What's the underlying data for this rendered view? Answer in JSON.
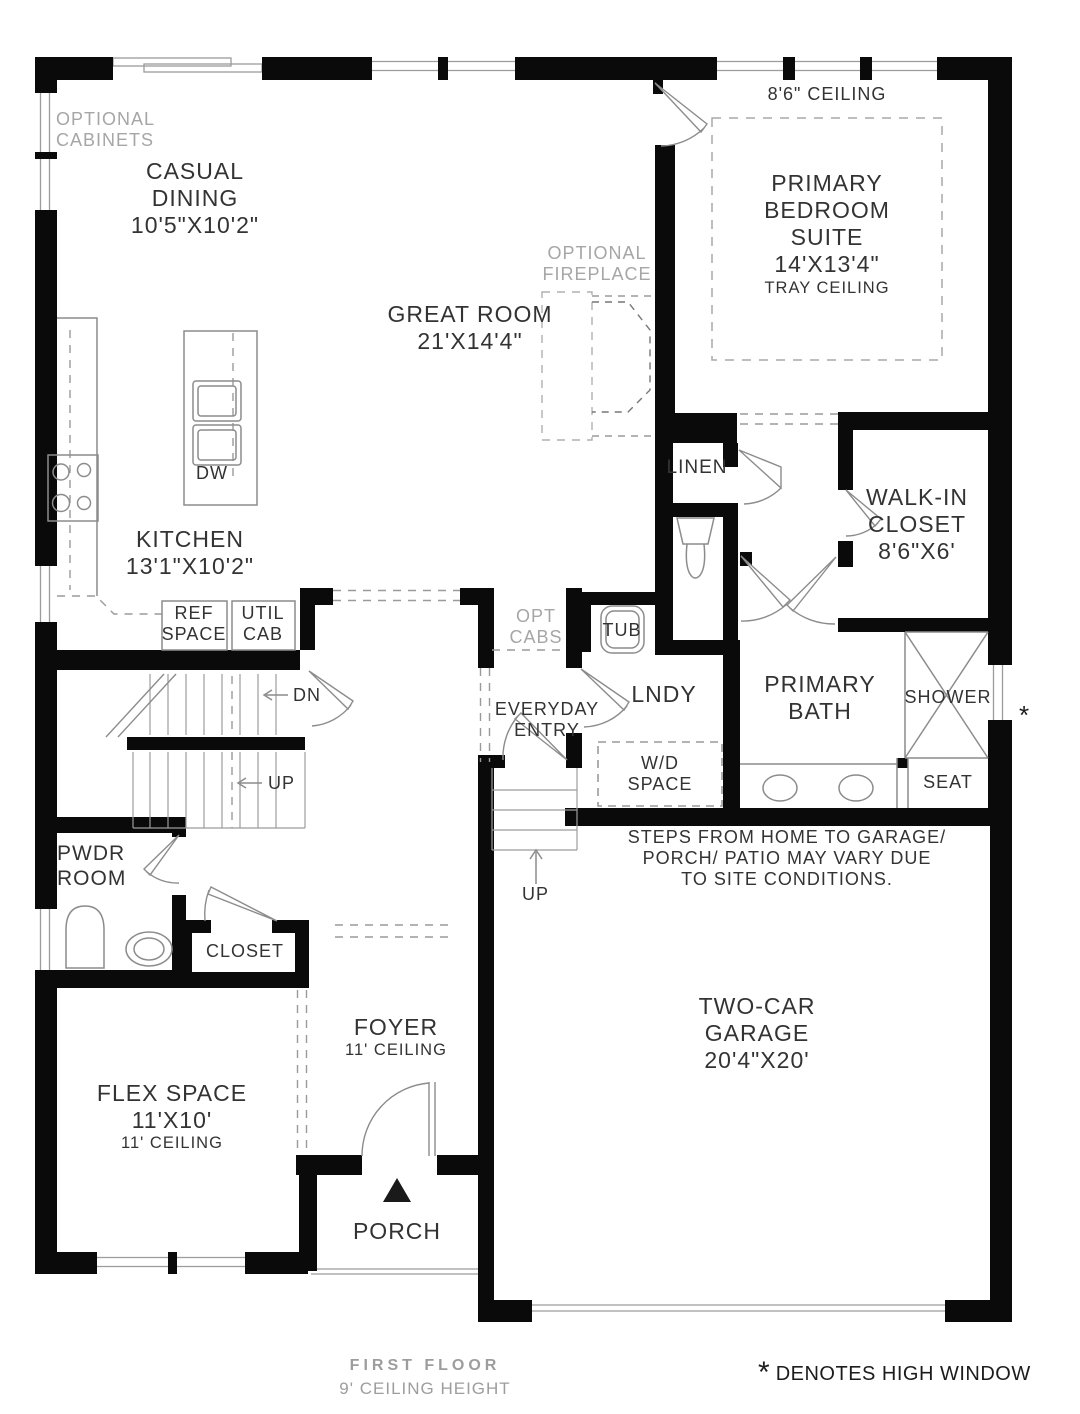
{
  "colors": {
    "wall": "#0a0a0a",
    "fixture_line": "#8c8c8c",
    "window_line": "#9c9c9c",
    "dash_line": "#9a9a9a",
    "text": "#333333",
    "muted_text": "#a6a6a6"
  },
  "rooms": {
    "casual_dining": {
      "line1": "CASUAL",
      "line2": "DINING",
      "dims": "10'5\"X10'2\""
    },
    "great_room": {
      "line1": "GREAT ROOM",
      "dims": "21'X14'4\""
    },
    "kitchen": {
      "line1": "KITCHEN",
      "dims": "13'1\"X10'2\""
    },
    "primary_bedroom": {
      "ceiling": "8'6\" CEILING",
      "line1": "PRIMARY",
      "line2": "BEDROOM",
      "line3": "SUITE",
      "dims": "14'X13'4\"",
      "sub": "TRAY CEILING"
    },
    "walk_in_closet": {
      "line1": "WALK-IN",
      "line2": "CLOSET",
      "dims": "8'6\"X6'"
    },
    "primary_bath": {
      "line1": "PRIMARY",
      "line2": "BATH"
    },
    "linen": "LINEN",
    "lndy": "LNDY",
    "everyday_entry": {
      "line1": "EVERYDAY",
      "line2": "ENTRY"
    },
    "pwdr_room": {
      "line1": "PWDR",
      "line2": "ROOM"
    },
    "closet": "CLOSET",
    "flex_space": {
      "line1": "FLEX SPACE",
      "dims": "11'X10'",
      "sub": "11' CEILING"
    },
    "foyer": {
      "line1": "FOYER",
      "sub": "11' CEILING"
    },
    "porch": "PORCH",
    "garage": {
      "line1": "TWO-CAR",
      "line2": "GARAGE",
      "dims": "20'4\"X20'"
    }
  },
  "annotations": {
    "optional_cabinets": {
      "line1": "OPTIONAL",
      "line2": "CABINETS"
    },
    "optional_fireplace": {
      "line1": "OPTIONAL",
      "line2": "FIREPLACE"
    },
    "opt_cabs": {
      "line1": "OPT",
      "line2": "CABS"
    },
    "ref_space": {
      "line1": "REF",
      "line2": "SPACE"
    },
    "util_cab": {
      "line1": "UTIL",
      "line2": "CAB"
    },
    "wd_space": {
      "line1": "W/D",
      "line2": "SPACE"
    },
    "dw": "DW",
    "tub": "TUB",
    "shower": "SHOWER",
    "seat": "SEAT",
    "dn": "DN",
    "up_stairs": "UP",
    "up_garage": "UP",
    "steps_note": {
      "line1": "STEPS FROM HOME TO GARAGE/",
      "line2": "PORCH/ PATIO MAY VARY DUE",
      "line3": "TO SITE CONDITIONS."
    },
    "high_window_marker": "*"
  },
  "footer": {
    "floor": "FIRST FLOOR",
    "ceiling": "9' CEILING HEIGHT",
    "note_mark": "*",
    "note": "DENOTES HIGH WINDOW"
  }
}
